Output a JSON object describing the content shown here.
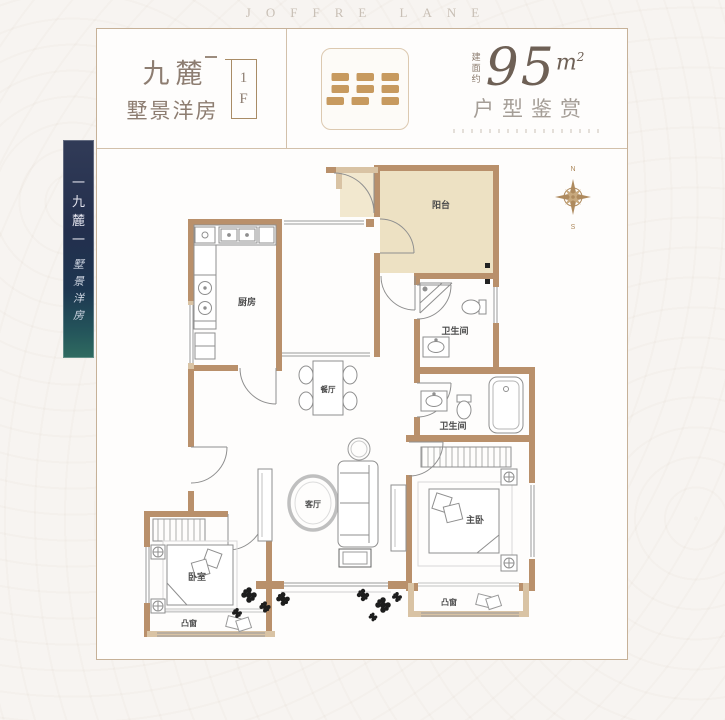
{
  "brand": {
    "wordmark": "JOFFRE LANE"
  },
  "header": {
    "project_name": "九麓",
    "product_type": "墅景洋房",
    "floor_digit": "1",
    "floor_letter": "F",
    "area_label": "建面约",
    "area_value": "95",
    "area_unit_base": "m",
    "area_unit_exp": "2",
    "tagline": "户型鉴赏"
  },
  "banner": {
    "chars": [
      "一",
      "九",
      "麓",
      "一"
    ],
    "sub_chars": [
      "墅",
      "景",
      "洋",
      "房"
    ]
  },
  "compass": {
    "north": "N",
    "south": "S"
  },
  "plan": {
    "rooms": {
      "balcony": "阳台",
      "kitchen": "厨房",
      "bathroom_upper": "卫生间",
      "bathroom_lower": "卫生间",
      "dining": "餐厅",
      "living": "客厅",
      "master_bedroom": "主卧",
      "bedroom": "卧室",
      "bay_window_master": "凸窗",
      "bay_window_bedroom": "凸窗"
    }
  },
  "colors": {
    "wall": "#b9906b",
    "wall_light": "#d9c3a4",
    "balcony_fill": "#ede1c3",
    "line": "#8f8f8f",
    "label": "#4d4d4d",
    "banner_navy": "#232f4d",
    "seal_gold": "#c79a5f",
    "card_border": "#c6b198"
  }
}
